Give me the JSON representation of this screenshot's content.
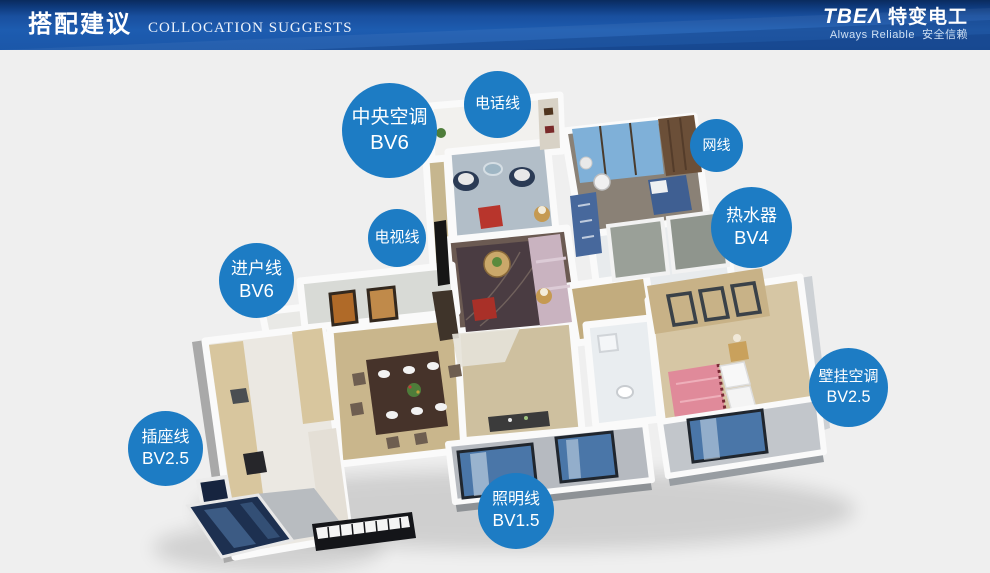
{
  "header": {
    "title_zh": "搭配建议",
    "title_en": "COLLOCATION SUGGESTS",
    "brand": {
      "logo_en": "TBEΛ",
      "logo_zh": "特变电工",
      "tagline_en": "Always Reliable",
      "tagline_zh": "安全信赖"
    }
  },
  "colors": {
    "header_navy": "#0a2b5e",
    "header_blue": "#1d5cb0",
    "bubble_blue": "#1d7cc4",
    "page_background": "#efefef"
  },
  "bubbles": [
    {
      "id": "central-ac",
      "lines": [
        "中央空调",
        "BV6"
      ]
    },
    {
      "id": "phone",
      "lines": [
        "电话线"
      ]
    },
    {
      "id": "network",
      "lines": [
        "网线"
      ]
    },
    {
      "id": "water-heater",
      "lines": [
        "热水器",
        "BV4"
      ]
    },
    {
      "id": "tv",
      "lines": [
        "电视线"
      ]
    },
    {
      "id": "entry",
      "lines": [
        "进户线",
        "BV6"
      ]
    },
    {
      "id": "wall-ac",
      "lines": [
        "壁挂空调",
        "BV2.5"
      ]
    },
    {
      "id": "socket",
      "lines": [
        "插座线",
        "BV2.5"
      ]
    },
    {
      "id": "lighting",
      "lines": [
        "照明线",
        "BV1.5"
      ]
    }
  ]
}
